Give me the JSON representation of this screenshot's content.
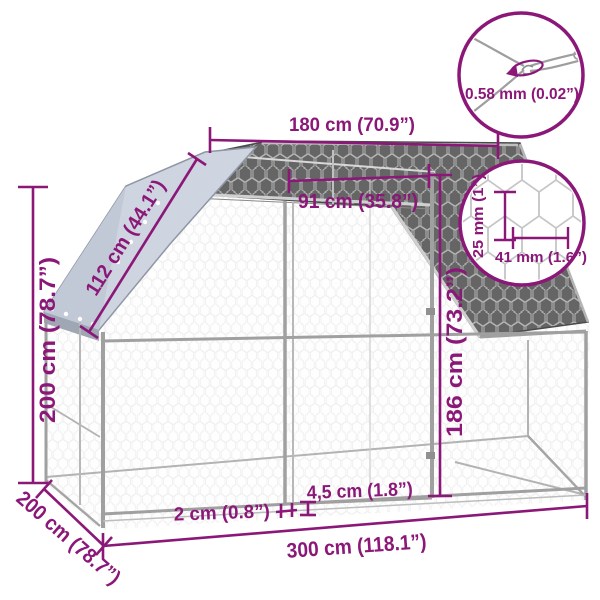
{
  "title": "Outdoor chicken cage dimension diagram",
  "colors": {
    "accent": "#8B1878",
    "frame_gray": "#a0a0a0",
    "roof_mesh_dark": "#656565",
    "tarp_gray": "#ced4e0"
  },
  "dimensions": {
    "top_width": "180 cm (70.9”)",
    "door_width": "91 cm (35.8”)",
    "roof_slope": "112 cm (44.1”)",
    "height": "200 cm (78.7”)",
    "door_height": "186 cm (73.2”)",
    "ground_clearance": "4,5 cm (1.8”)",
    "frame_tube": "2 cm (0.8”)",
    "base_width": "300 cm (118.1”)",
    "depth": "200 cm (78.7”)"
  },
  "details": {
    "wire_thickness": "0.58 mm (0.02”)",
    "mesh_cell_height": "25 mm (1”)",
    "mesh_cell_width": "41 mm (1.6”)"
  }
}
